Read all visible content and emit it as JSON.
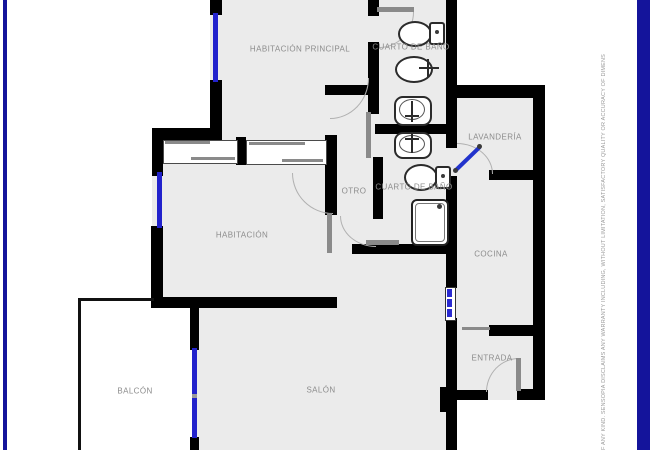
{
  "floorplan": {
    "rooms": [
      {
        "id": "habitacion-principal",
        "label": "HABITACIÓN PRINCIPAL"
      },
      {
        "id": "cuarto-de-bano-1",
        "label": "CUARTO DE BAÑO"
      },
      {
        "id": "lavanderia",
        "label": "LAVANDERÍA"
      },
      {
        "id": "otro",
        "label": "OTRO"
      },
      {
        "id": "cuarto-de-bano-2",
        "label": "CUARTO DE BAÑO"
      },
      {
        "id": "habitacion",
        "label": "HABITACIÓN"
      },
      {
        "id": "cocina",
        "label": "COCINA"
      },
      {
        "id": "entrada",
        "label": "ENTRADA"
      },
      {
        "id": "balcon",
        "label": "BALCÓN"
      },
      {
        "id": "salon",
        "label": "SALÓN"
      }
    ],
    "fixtures": [
      "toilet",
      "bidet",
      "sink",
      "sink",
      "toilet",
      "shower"
    ],
    "disclaimer": "F ANY KIND. SENSOPIA DISCLAIMS ANY WARRANTY INCLUDING, WITHOUT LIMITATION, SATISFACTORY QUALITY OR ACCURACY OF DIMENS",
    "colors": {
      "wall": "#000000",
      "room_fill": "#ebebeb",
      "window": "#2222cc",
      "frame": "#14149b",
      "label": "#8c8c8c",
      "door_arc": "#b0b0b0",
      "door_leaf": "#8a8a8a"
    }
  }
}
